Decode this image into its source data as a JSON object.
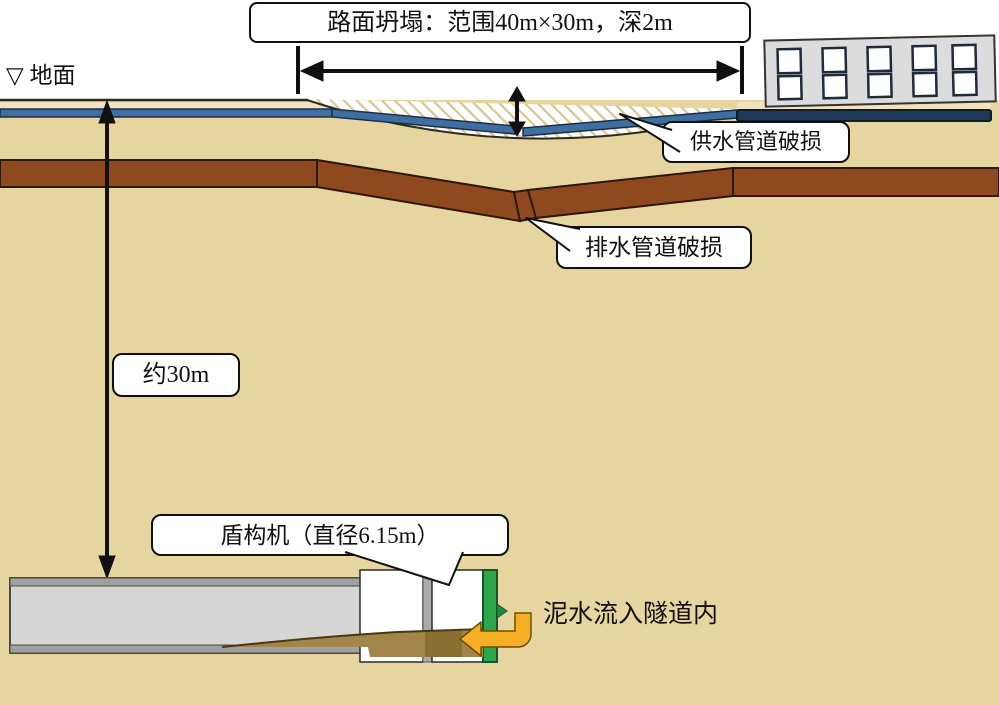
{
  "scene": {
    "collapse_label": "路面坍塌：范围40m×30m，深2m",
    "ground_label": "▽ 地面",
    "water_pipe_label": "供水管道破损",
    "drain_pipe_label": "排水管道破损",
    "depth_label": "约30m",
    "shield_label": "盾构机（直径6.15m）",
    "mud_label": "泥水流入隧道内",
    "colors": {
      "soil": "#e7d5a0",
      "water_pipe_blue": "#3f6f9e",
      "pavement_navy": "#1f3a58",
      "drain_pipe_brown": "#8e4a1e",
      "cutter_face_green": "#2ca54b",
      "mud_flow": "#a1854a",
      "inflow_arrow_orange": "#f6ae24"
    }
  }
}
